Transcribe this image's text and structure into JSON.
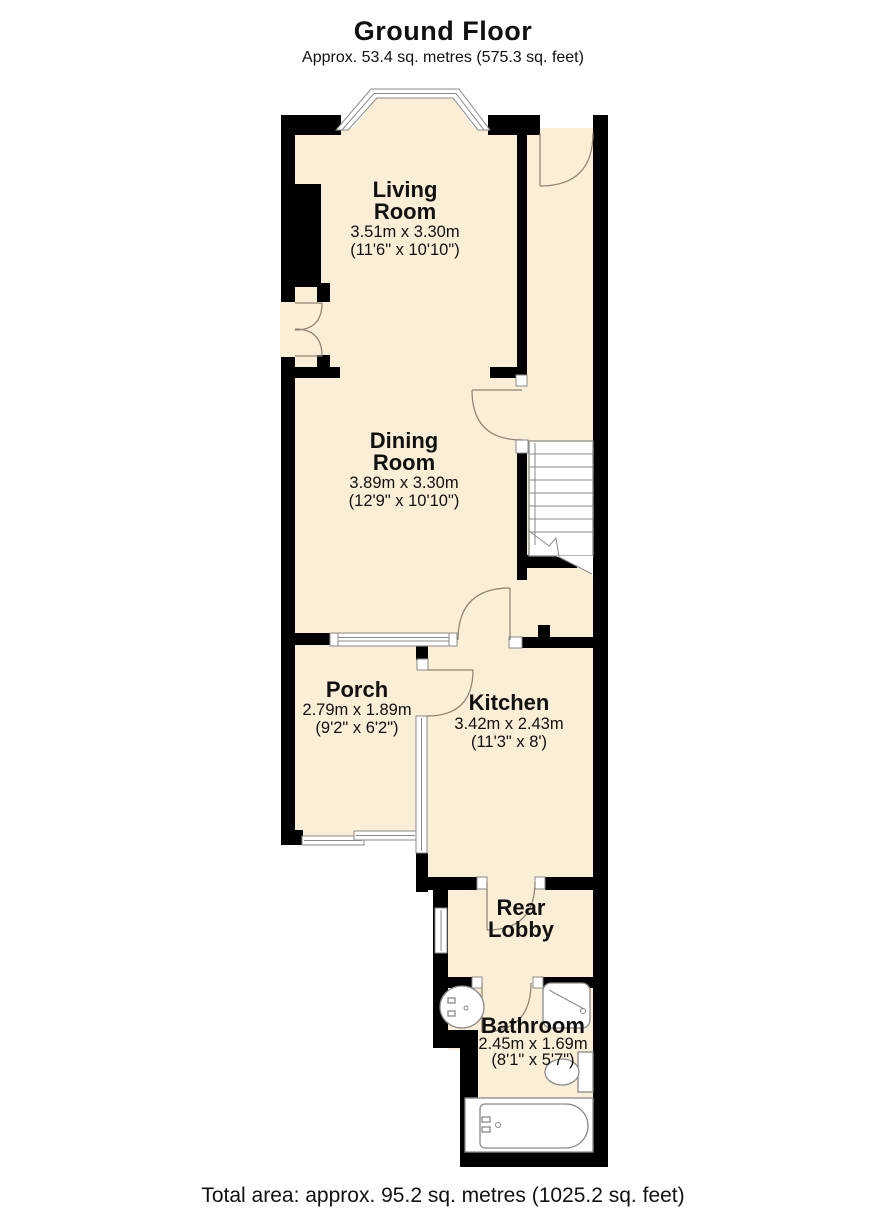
{
  "header": {
    "title": "Ground Floor",
    "subtitle": "Approx. 53.4 sq. metres (575.3 sq. feet)"
  },
  "rooms": {
    "living": {
      "line1": "Living",
      "line2": "Room",
      "size_metric": "3.51m x 3.30m",
      "size_imperial": "(11'6\" x 10'10\")"
    },
    "dining": {
      "line1": "Dining",
      "line2": "Room",
      "size_metric": "3.89m x 3.30m",
      "size_imperial": "(12'9\" x 10'10\")"
    },
    "porch": {
      "line1": "Porch",
      "size_metric": "2.79m x 1.89m",
      "size_imperial": "(9'2\" x 6'2\")"
    },
    "kitchen": {
      "line1": "Kitchen",
      "size_metric": "3.42m x 2.43m",
      "size_imperial": "(11'3\" x 8')"
    },
    "rear_lobby": {
      "line1": "Rear",
      "line2": "Lobby"
    },
    "bathroom": {
      "line1": "Bathroom",
      "size_metric": "2.45m x 1.69m",
      "size_imperial": "(8'1\" x 5'7\")"
    }
  },
  "footer": {
    "total_area": "Total area: approx. 95.2 sq. metres (1025.2 sq. feet)"
  },
  "colors": {
    "wall": "#000000",
    "floor": "#fbeed6",
    "line": "#8c8274",
    "fixture": "#8a8a8a",
    "text": "#111111",
    "background": "#ffffff"
  }
}
